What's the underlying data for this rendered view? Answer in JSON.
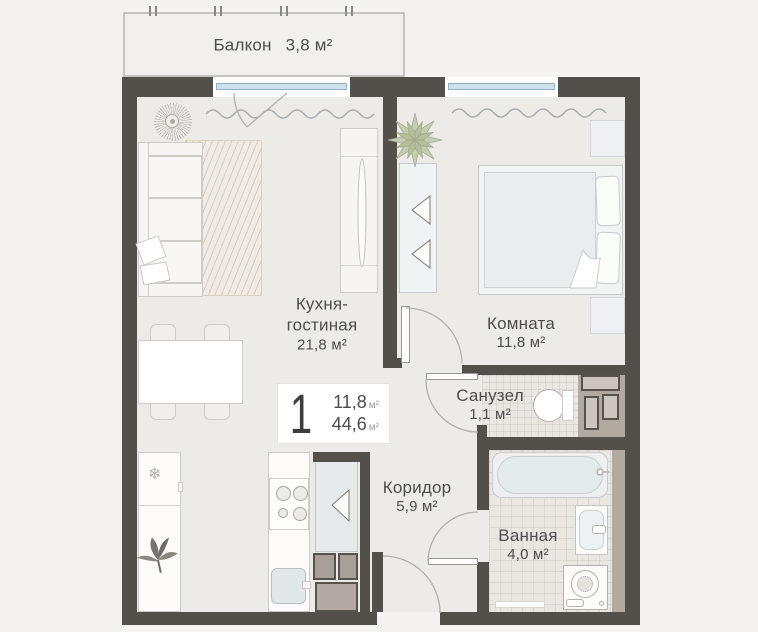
{
  "rooms": {
    "balcony": {
      "name": "Балкон",
      "area": "3,8 м²"
    },
    "kitchen_living": {
      "name1": "Кухня-",
      "name2": "гостиная",
      "area": "21,8 м²"
    },
    "room": {
      "name": "Комната",
      "area": "11,8 м²"
    },
    "wc": {
      "name": "Санузел",
      "area": "1,1 м²"
    },
    "corridor": {
      "name": "Коридор",
      "area": "5,9 м²"
    },
    "bathroom": {
      "name": "Ванная",
      "area": "4,0 м²"
    }
  },
  "badge": {
    "number": "1",
    "room_area": "11,8",
    "total_area": "44,6",
    "unit": "м²"
  },
  "icons": {
    "snowflake": "❄"
  },
  "colors": {
    "wall": "#53504c",
    "floor": "#edebe7",
    "tile": "#eae6e2",
    "window": "#cde1ea",
    "plant": "#c6ccb1",
    "shaft": "#b2aaa1",
    "balcony_floor": "#f1f0ee",
    "text": "#4d4d4d"
  }
}
